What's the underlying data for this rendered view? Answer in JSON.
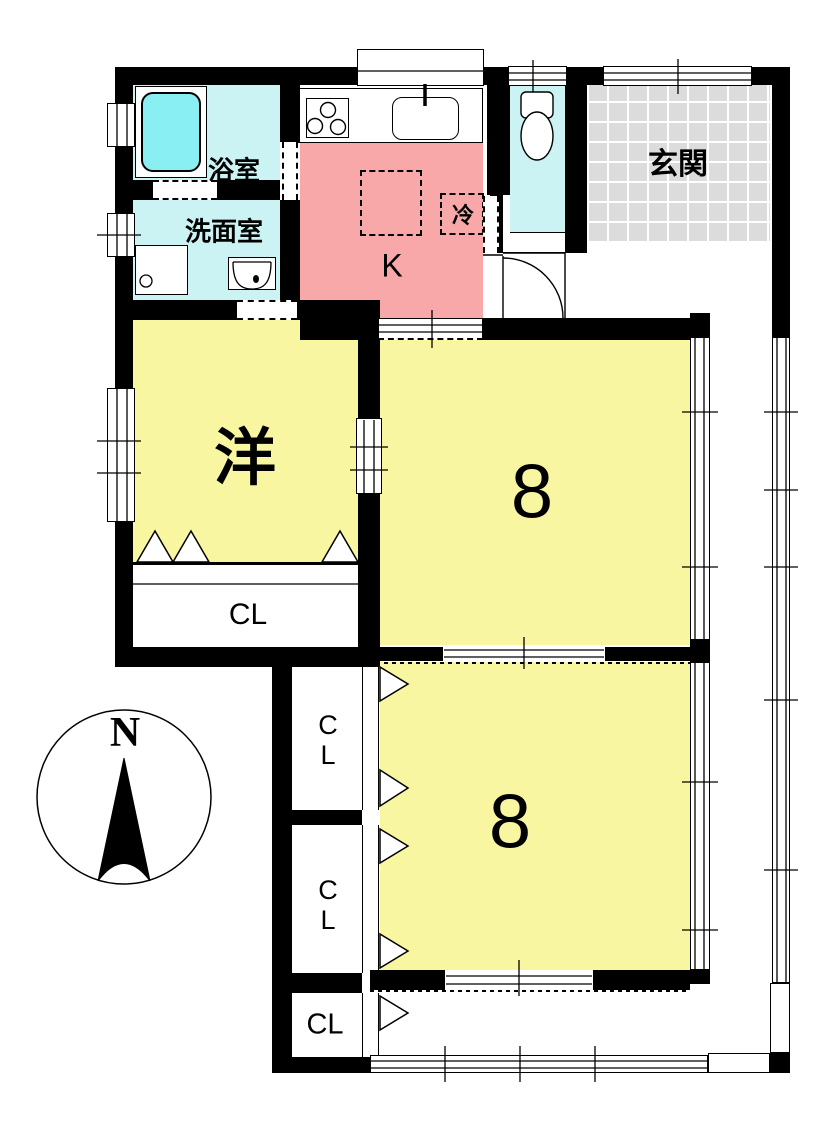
{
  "plan_title": "floor-plan",
  "compass": {
    "north": "N"
  },
  "rooms": {
    "bathroom": {
      "label": "浴室"
    },
    "washroom": {
      "label": "洗面室"
    },
    "kitchen": {
      "label": "K"
    },
    "refrigerator": {
      "label": "冷"
    },
    "entrance": {
      "label": "玄関"
    },
    "western_room": {
      "label": "洋"
    },
    "tatami_room_upper": {
      "label": "8"
    },
    "tatami_room_lower": {
      "label": "8"
    },
    "closet_western": {
      "label": "CL"
    },
    "closet_upper": {
      "label": "CL"
    },
    "closet_middle": {
      "label": "CL"
    },
    "closet_lower": {
      "label": "CL"
    }
  },
  "colors": {
    "room_yellow": "#F9F6A2",
    "kitchen_pink": "#F8A8A8",
    "wet_cyan": "#CBF3F4",
    "tub_cyan": "#8AEFF2",
    "entrance_gray": "#DCDCDC",
    "wall_black": "#000000"
  }
}
